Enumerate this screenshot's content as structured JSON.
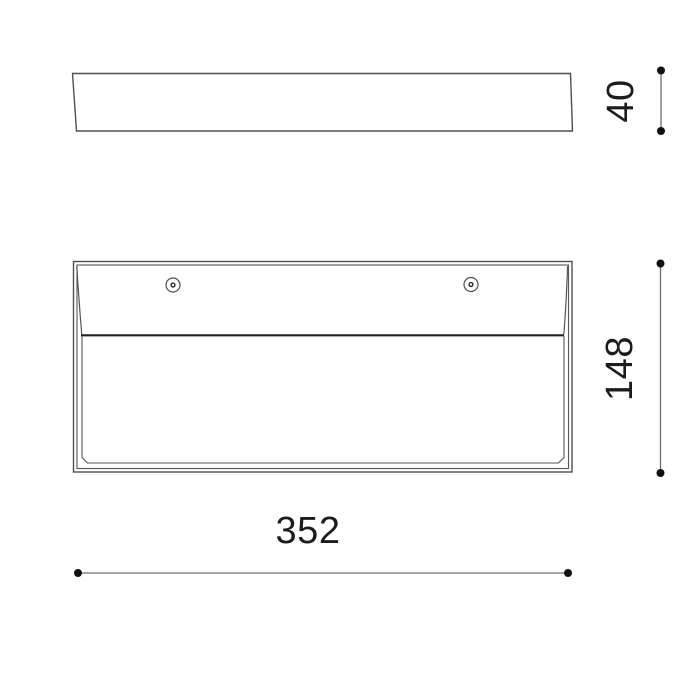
{
  "drawing": {
    "dimensions": {
      "depth": "40",
      "height": "148",
      "width": "352"
    },
    "screws": {
      "count": 2,
      "symbol": "screw-hole-icon"
    },
    "colors": {
      "background": "#ffffff",
      "outline": "#4f4f4f",
      "divider_line": "#1f1f1f",
      "dimension_line": "#6e6e6e",
      "dimension_dot": "#111111",
      "text": "#1c1c1c"
    }
  }
}
